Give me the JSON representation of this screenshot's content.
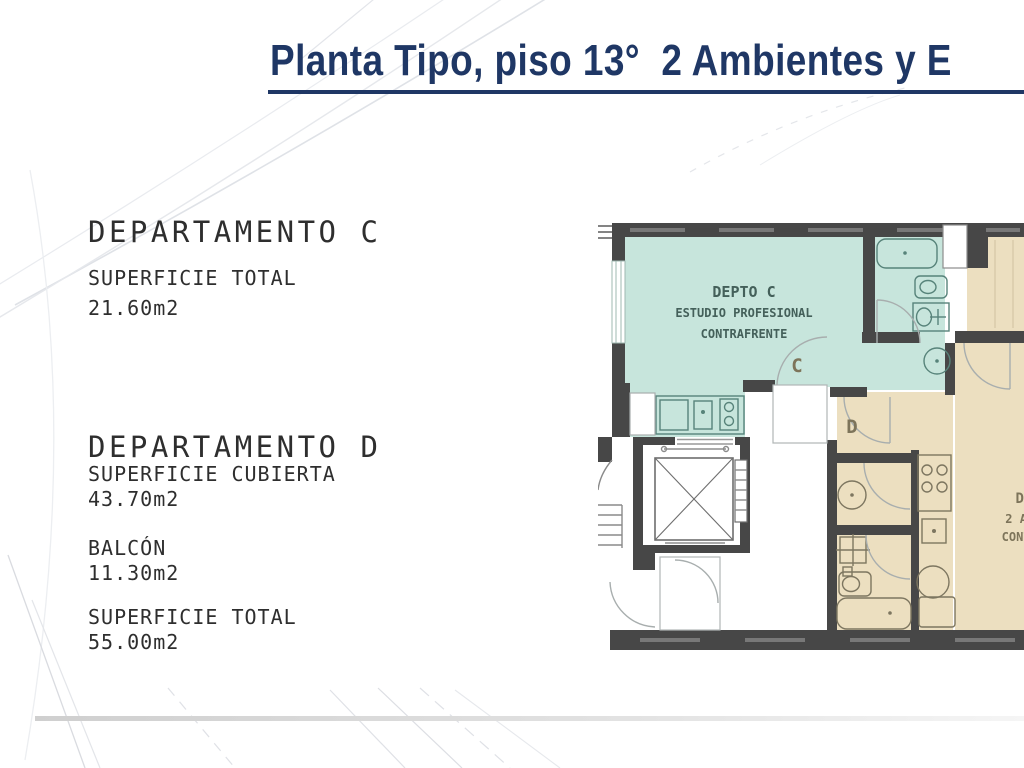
{
  "header": {
    "title": "Planta Tipo, piso 13°  2 Ambientes y E",
    "accent_color": "#1f3765"
  },
  "left_panel": {
    "unit_c": {
      "title": "DEPARTAMENTO C",
      "rows": [
        {
          "label": "SUPERFICIE TOTAL",
          "value": "21.60m2"
        }
      ]
    },
    "unit_d": {
      "title": "DEPARTAMENTO D",
      "rows": [
        {
          "label": "SUPERFICIE CUBIERTA",
          "value": "43.70m2"
        },
        {
          "label": "BALCÓN",
          "value": "11.30m2"
        },
        {
          "label": "SUPERFICIE TOTAL",
          "value": "55.00m2"
        }
      ]
    }
  },
  "floorplan": {
    "unit_c_label": {
      "line1": "DEPTO C",
      "line2": "ESTUDIO PROFESIONAL",
      "line3": "CONTRAFRENTE"
    },
    "unit_d_label": {
      "line1": "DEPTO D",
      "line2": "2 AMBIENTES",
      "line3": "CONTRAFRENTE"
    },
    "door_labels": {
      "c": "C",
      "d": "D"
    },
    "colors": {
      "unit_c_fill": "#c7e5dc",
      "unit_d_fill": "#ecdfc0",
      "wall": "#474747",
      "fixture_teal": "#57837a",
      "fixture_beige": "#7d7660"
    }
  }
}
